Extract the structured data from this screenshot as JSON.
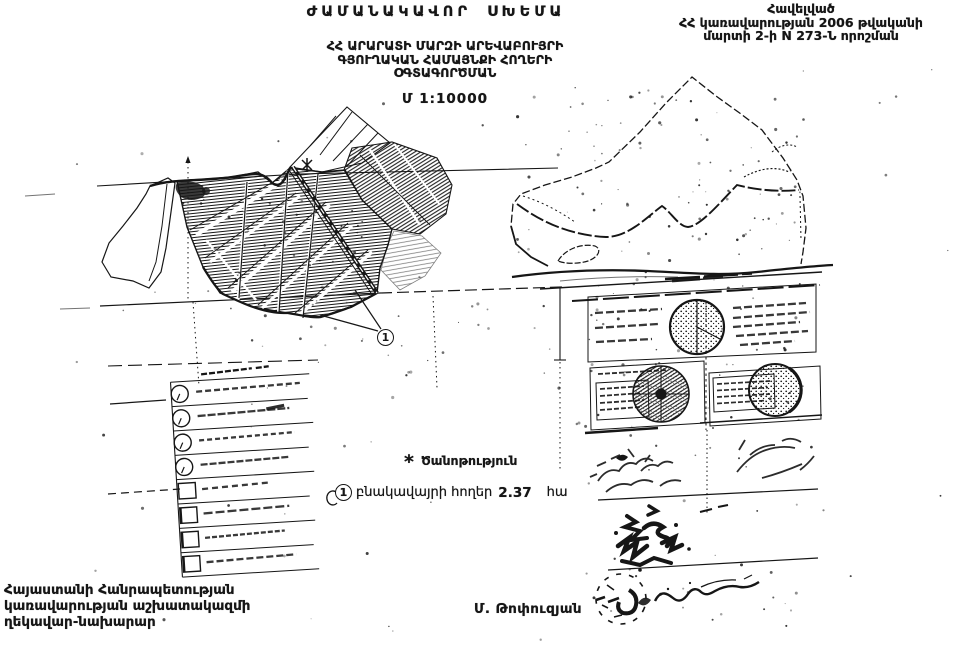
{
  "colors": {
    "ink": "#161616",
    "paper": "#ffffff"
  },
  "annex": {
    "line1": "Հավելված",
    "line2": "ՀՀ կառավարության 2006 թվականի",
    "line3": "մարտի 2-ի N 273-Ն որոշման"
  },
  "title": "ԺԱՄԱՆԱԿԱՎՈՐ ՍԽԵՄԱ",
  "subtitle": {
    "line1": "ՀՀ ԱՐԱՐԱՏԻ ՄԱՐԶԻ ԱՐԵՎԱԲՈՒՅՐԻ",
    "line2": "ԳՅՈՒՂԱԿԱՆ ՀԱՄԱՅՆՔԻ ՀՈՂԵՐԻ",
    "line3": "ՕԳՏԱԳՈՐԾՄԱՆ"
  },
  "scale": "Մ 1:10000",
  "note": {
    "marker": "*",
    "header": "Ծանոթություն",
    "item_number": "1",
    "item_text": "բնակավայրի հողեր",
    "item_value": "2.37",
    "item_unit": "հա"
  },
  "map_marker": {
    "label": "1"
  },
  "officials": {
    "line1": "Հայաստանի Հանրապետության",
    "line2": "կառավարության աշխատակազմի",
    "line3": "ղեկավար-նախարար"
  },
  "signatory": "Մ. Թոփուզյան"
}
